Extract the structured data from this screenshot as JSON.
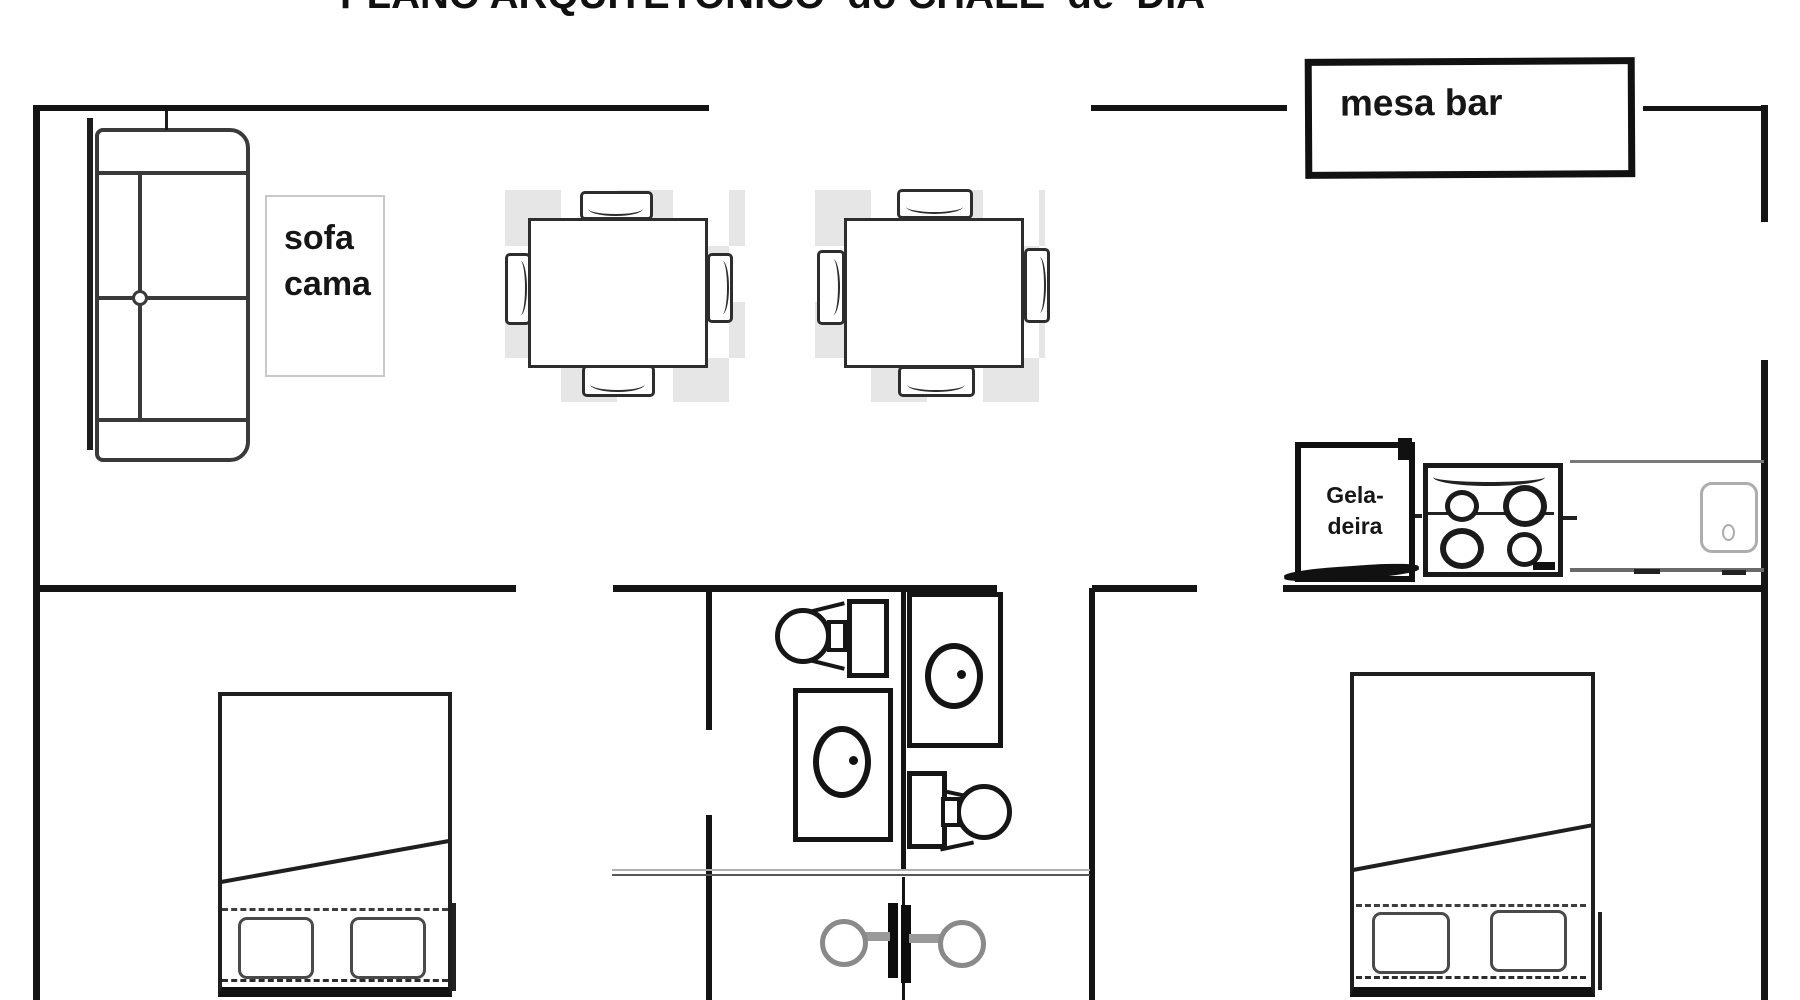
{
  "title": "PLANO ARQUITETÔNICO  do CHALÉ  de  DIA",
  "labels": {
    "sofa_line1": "sofa",
    "sofa_line2": "cama",
    "mesa_bar": "mesa bar",
    "geladeira_line1": "Gela-",
    "geladeira_line2": "deira"
  },
  "colors": {
    "wall": "#141414",
    "furniture_line": "#2d2d2d",
    "checker_gray": "#e6e6e6",
    "counter_line": "#7a7a7a",
    "knob_gray": "#8a8a8a",
    "label_border": "#c9c9c9"
  }
}
